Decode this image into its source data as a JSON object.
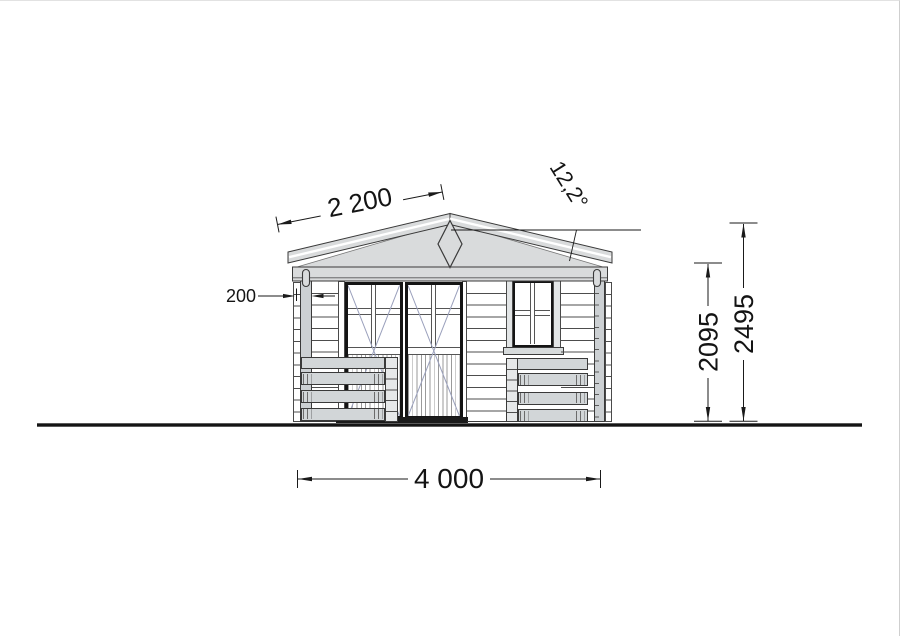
{
  "drawing": {
    "title": "log-cabin-front-elevation",
    "annotations": {
      "roof_slope_length": "2 200",
      "roof_angle": "12,2°",
      "log_thickness": "200",
      "wall_height": "2095",
      "ridge_height": "2495",
      "total_width": "4 000"
    },
    "palette": {
      "fill_gray": "#d9dbdc",
      "line_dark": "#1a1a1a",
      "swing_line_blue": "#9aa0bc"
    },
    "elements": {
      "roof_ornament": "diamond",
      "left_unit": "glazed double door",
      "right_unit": "four-pane window",
      "front": "two railing sections"
    }
  }
}
